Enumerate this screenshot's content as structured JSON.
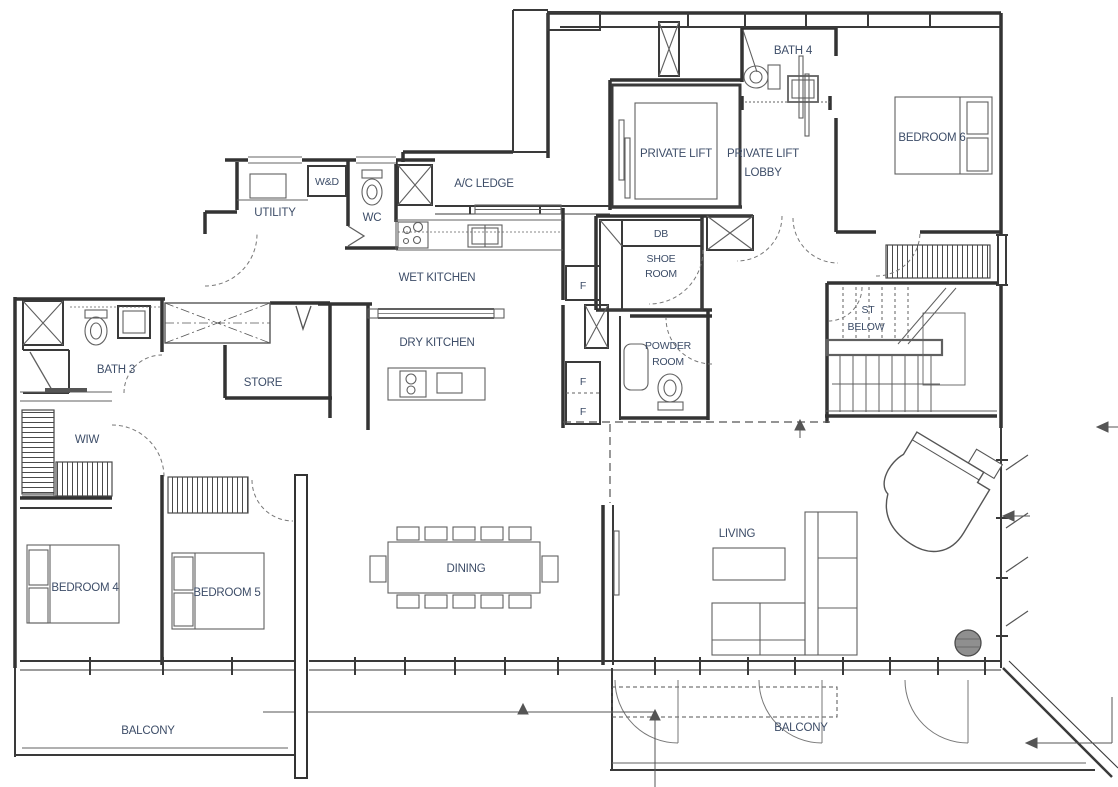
{
  "title": "Floor Plan",
  "colors": {
    "background": "#ffffff",
    "wall": "#333333",
    "wall_medium": "#3a3a3a",
    "thin_line": "#606060",
    "dash_line": "#777777",
    "label_text": "#3d4d68",
    "column_fill": "#8f8f8f"
  },
  "labels": {
    "bath4": "BATH 4",
    "bedroom6": "BEDROOM 6",
    "private_lift": "PRIVATE LIFT",
    "private_lift_lobby_1": "PRIVATE LIFT",
    "private_lift_lobby_2": "LOBBY",
    "ac_ledge": "A/C LEDGE",
    "utility": "UTILITY",
    "wd": "W&D",
    "wc": "WC",
    "wet_kitchen": "WET KITCHEN",
    "dry_kitchen": "DRY KITCHEN",
    "db": "DB",
    "shoe_1": "SHOE",
    "shoe_2": "ROOM",
    "f": "F",
    "powder_1": "POWDER",
    "powder_2": "ROOM",
    "st_1": "ST",
    "st_2": "BELOW",
    "bath3": "BATH 3",
    "store": "STORE",
    "wiw": "WIW",
    "bedroom4": "BEDROOM 4",
    "bedroom5": "BEDROOM 5",
    "dining": "DINING",
    "living": "LIVING",
    "balcony_left": "BALCONY",
    "balcony_right": "BALCONY"
  }
}
